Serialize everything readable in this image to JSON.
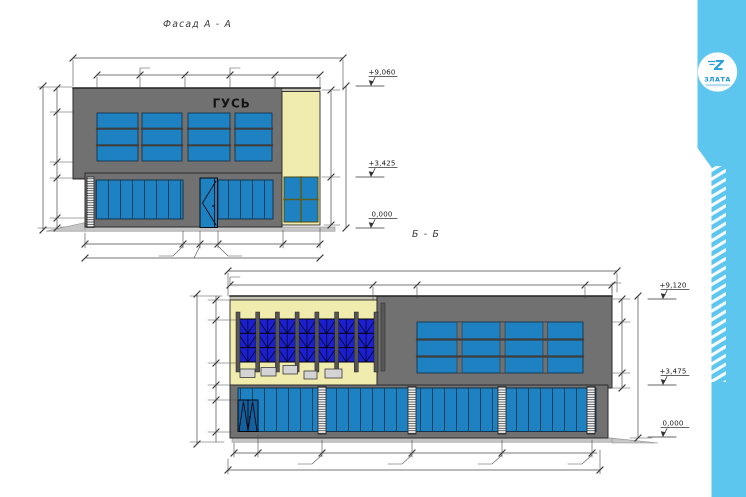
{
  "sheet": {
    "title_a": "Фасад А - А",
    "title_b": "Б - Б",
    "background": "#ffffff"
  },
  "facade_a": {
    "sign_text": "ГУСЬ",
    "levels": [
      {
        "label": "+9,060"
      },
      {
        "label": "+3,425"
      },
      {
        "label": "0,000"
      }
    ]
  },
  "facade_b": {
    "levels": [
      {
        "label": "+9,120"
      },
      {
        "label": "+3,475"
      },
      {
        "label": "0,000"
      }
    ]
  },
  "logo": {
    "monogram": "Z",
    "company": "ЗЛАТА"
  },
  "colors": {
    "accent_bar": "#5dc6ee",
    "facade_gray": "#717171",
    "window_blue": "#1e81c1",
    "deep_blue": "#1b1fd0",
    "cream": "#f0ecae",
    "logo_blue": "#2398d3"
  }
}
